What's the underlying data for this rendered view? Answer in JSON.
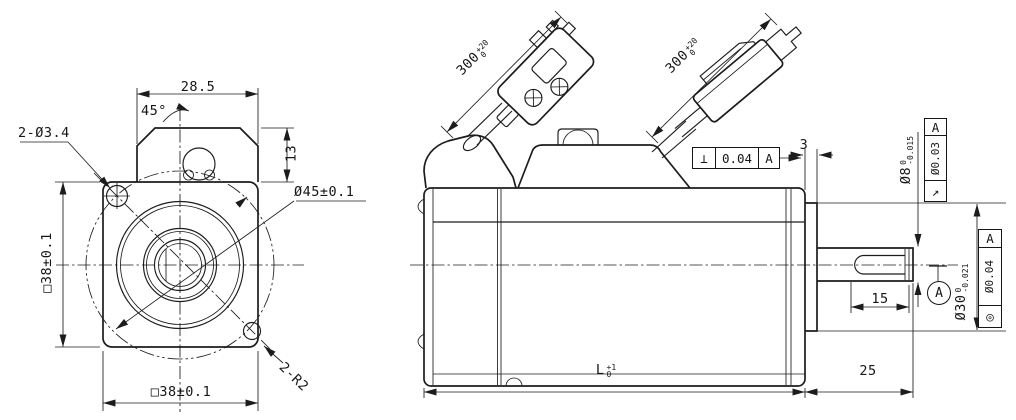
{
  "drawing": {
    "type": "engineering outline drawing - servo motor front and side views",
    "front_view": {
      "dim_box_width": "28.5",
      "dim_chamfer_angle": "45°",
      "dim_mount_holes": "2-Ø3.4",
      "dim_box_height": "13",
      "dim_bolt_circle_dia": "Ø45±0.1",
      "dim_flange_size_side": "□38±0.1",
      "dim_flange_size_bottom": "□38±0.1",
      "dim_corner_radius": "2-R2"
    },
    "side_view": {
      "dim_encoder_cable": {
        "value": "300",
        "upper": "+20",
        "lower": "0"
      },
      "dim_power_cable": {
        "value": "300",
        "upper": "+20",
        "lower": "0"
      },
      "dim_boss_protrusion": "3",
      "dim_shaft_dia": {
        "value": "Ø8",
        "upper": "0",
        "lower": "-0.015"
      },
      "dim_boss_dia": {
        "value": "Ø30",
        "upper": "0",
        "lower": "-0.021"
      },
      "dim_key_length": "15",
      "dim_shaft_length": "25",
      "dim_body_length": {
        "value": "L",
        "upper": "+1",
        "lower": "0"
      },
      "gdt_perpendicularity": {
        "symbol": "⊥",
        "tolerance": "0.04",
        "datum": "A"
      },
      "gdt_circular_runout": {
        "symbol": "↗",
        "tolerance": "Ø0.03",
        "datum": "A"
      },
      "gdt_concentricity": {
        "symbol": "◎",
        "tolerance": "Ø0.04",
        "datum": "A"
      },
      "datum_label": "A"
    }
  }
}
